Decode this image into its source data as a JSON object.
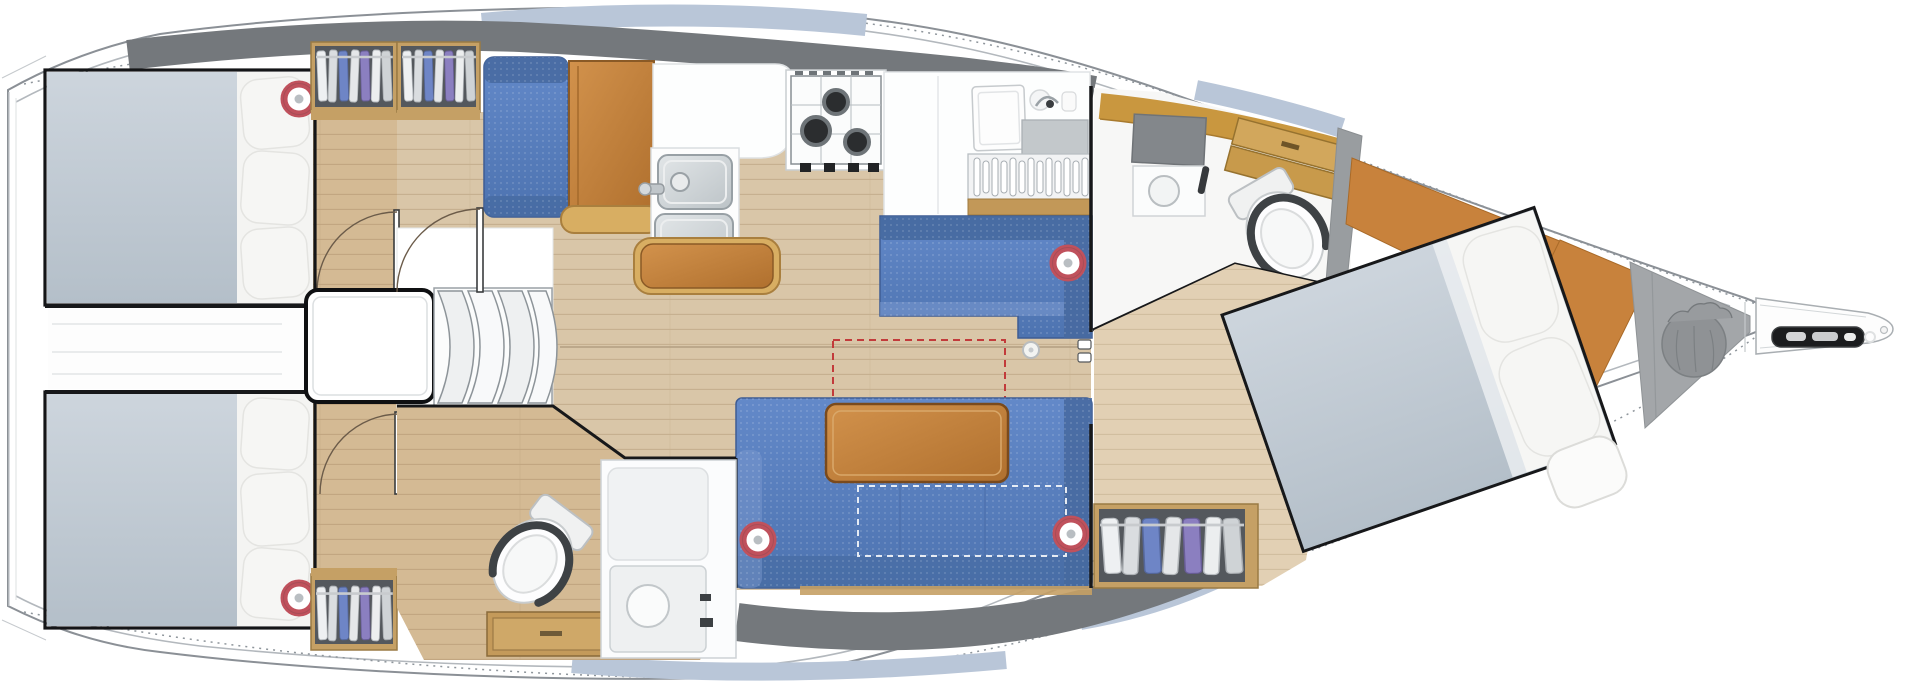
{
  "vessel": {
    "type": "sailing-yacht-interior-floor-plan",
    "view": "top-down",
    "bow_direction": "right"
  },
  "colors": {
    "bg": "#ffffff",
    "hull_outline": "#8b9096",
    "deck_gray": "#74787c",
    "window_tint": "#b9c6d8",
    "floor_main": "#d9c6a8",
    "floor_cabin": "#d4ba94",
    "floor_fwd": "#e2d0b4",
    "upholstery_blue": "#5b82c2",
    "upholstery_blue_dark": "#46699f",
    "mattress": "#c3cdd6",
    "pillow": "#f6f6f4",
    "wood": "#c28340",
    "wood_trim": "#c5a065",
    "locker": "#54585d",
    "wall": "#17181a",
    "speaker_ring": "#c0515c",
    "stainless": "#ccd2d5",
    "anchor_locker_gray": "#a3a6a9",
    "sail_bag_gray": "#8f9295",
    "table_dashed_red": "#c23b3b"
  },
  "rooms": [
    {
      "id": "aft-cabin-port",
      "label": "aft cabin port with double berth and wardrobe"
    },
    {
      "id": "aft-cabin-starboard",
      "label": "aft cabin starboard with double berth and wardrobe"
    },
    {
      "id": "companionway",
      "label": "companionway steps and engine box"
    },
    {
      "id": "galley",
      "label": "galley with double sink, 3-burner stove, fridge and dish rack"
    },
    {
      "id": "salon",
      "label": "salon with L-settees and wood table"
    },
    {
      "id": "aft-head",
      "label": "aft head with toilet and shower"
    },
    {
      "id": "forward-head",
      "label": "forward head with toilet, vanity and shower"
    },
    {
      "id": "forward-cabin",
      "label": "owner forward cabin with angled island berth"
    },
    {
      "id": "bow-locker",
      "label": "anchor sail locker and bowsprit"
    }
  ],
  "equipment_counts": {
    "speakers": 5,
    "stove_burners": 3,
    "galley_sinks": 2,
    "toilets": 2,
    "showers": 2,
    "wardrobes": 4,
    "berths": 3
  }
}
